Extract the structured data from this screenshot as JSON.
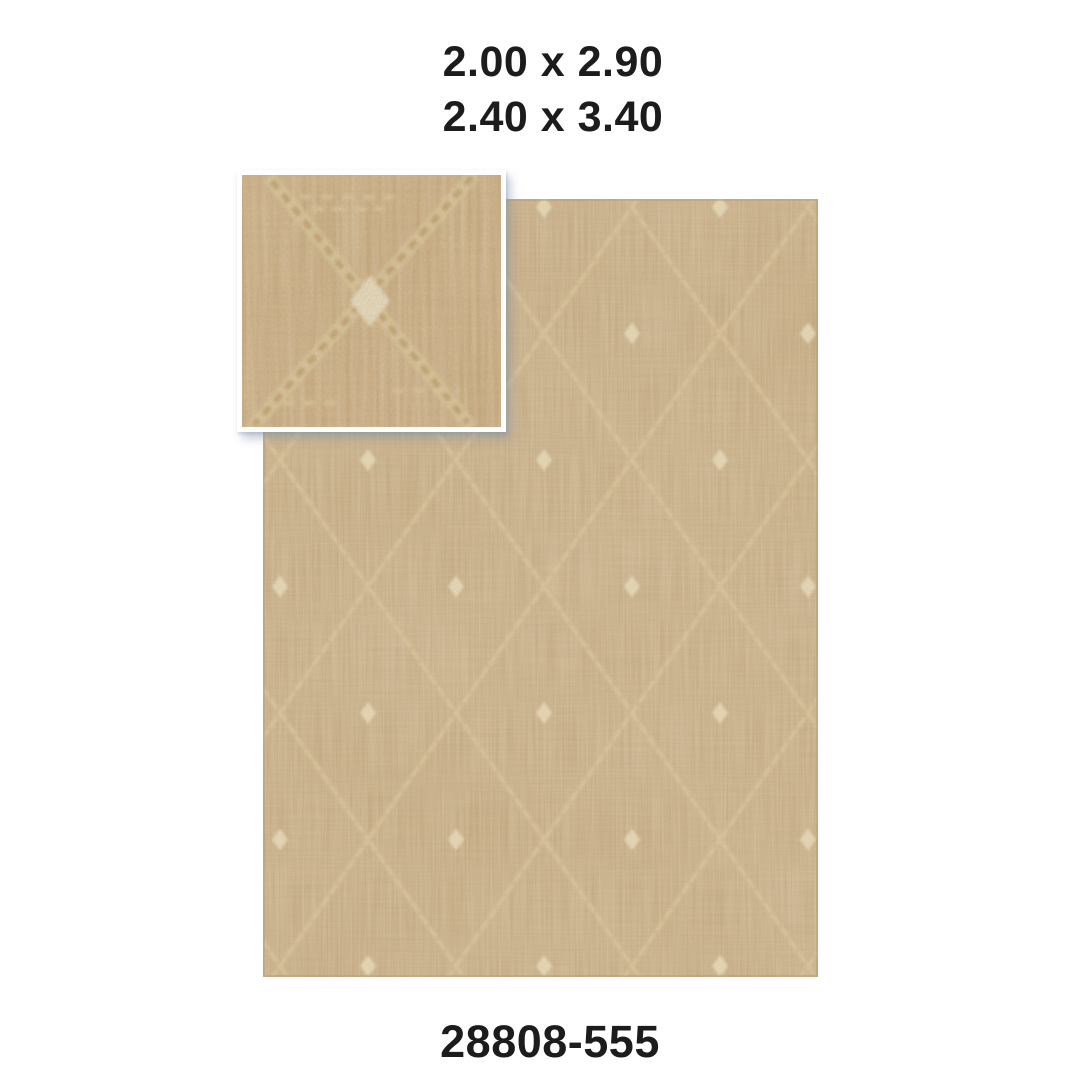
{
  "labels": {
    "sizes": [
      "2.00 x 2.90",
      "2.40 x 3.40"
    ],
    "product_code": "28808-555"
  },
  "colors": {
    "background": "#ffffff",
    "text": "#1c1c1c",
    "rug_base": "#c8a97c",
    "rug_lattice": "#d6bf97",
    "rug_lattice_bead": "#e0cda6",
    "rug_dot": "#ecdfbd",
    "rug_edge": "#b79c70",
    "inset_base": "#cbab7e",
    "inset_line": "#dcc9a0",
    "inset_braid": "#c2a372",
    "inset_highlight": "#e9ddc1",
    "inset_border": "#ffffff"
  }
}
